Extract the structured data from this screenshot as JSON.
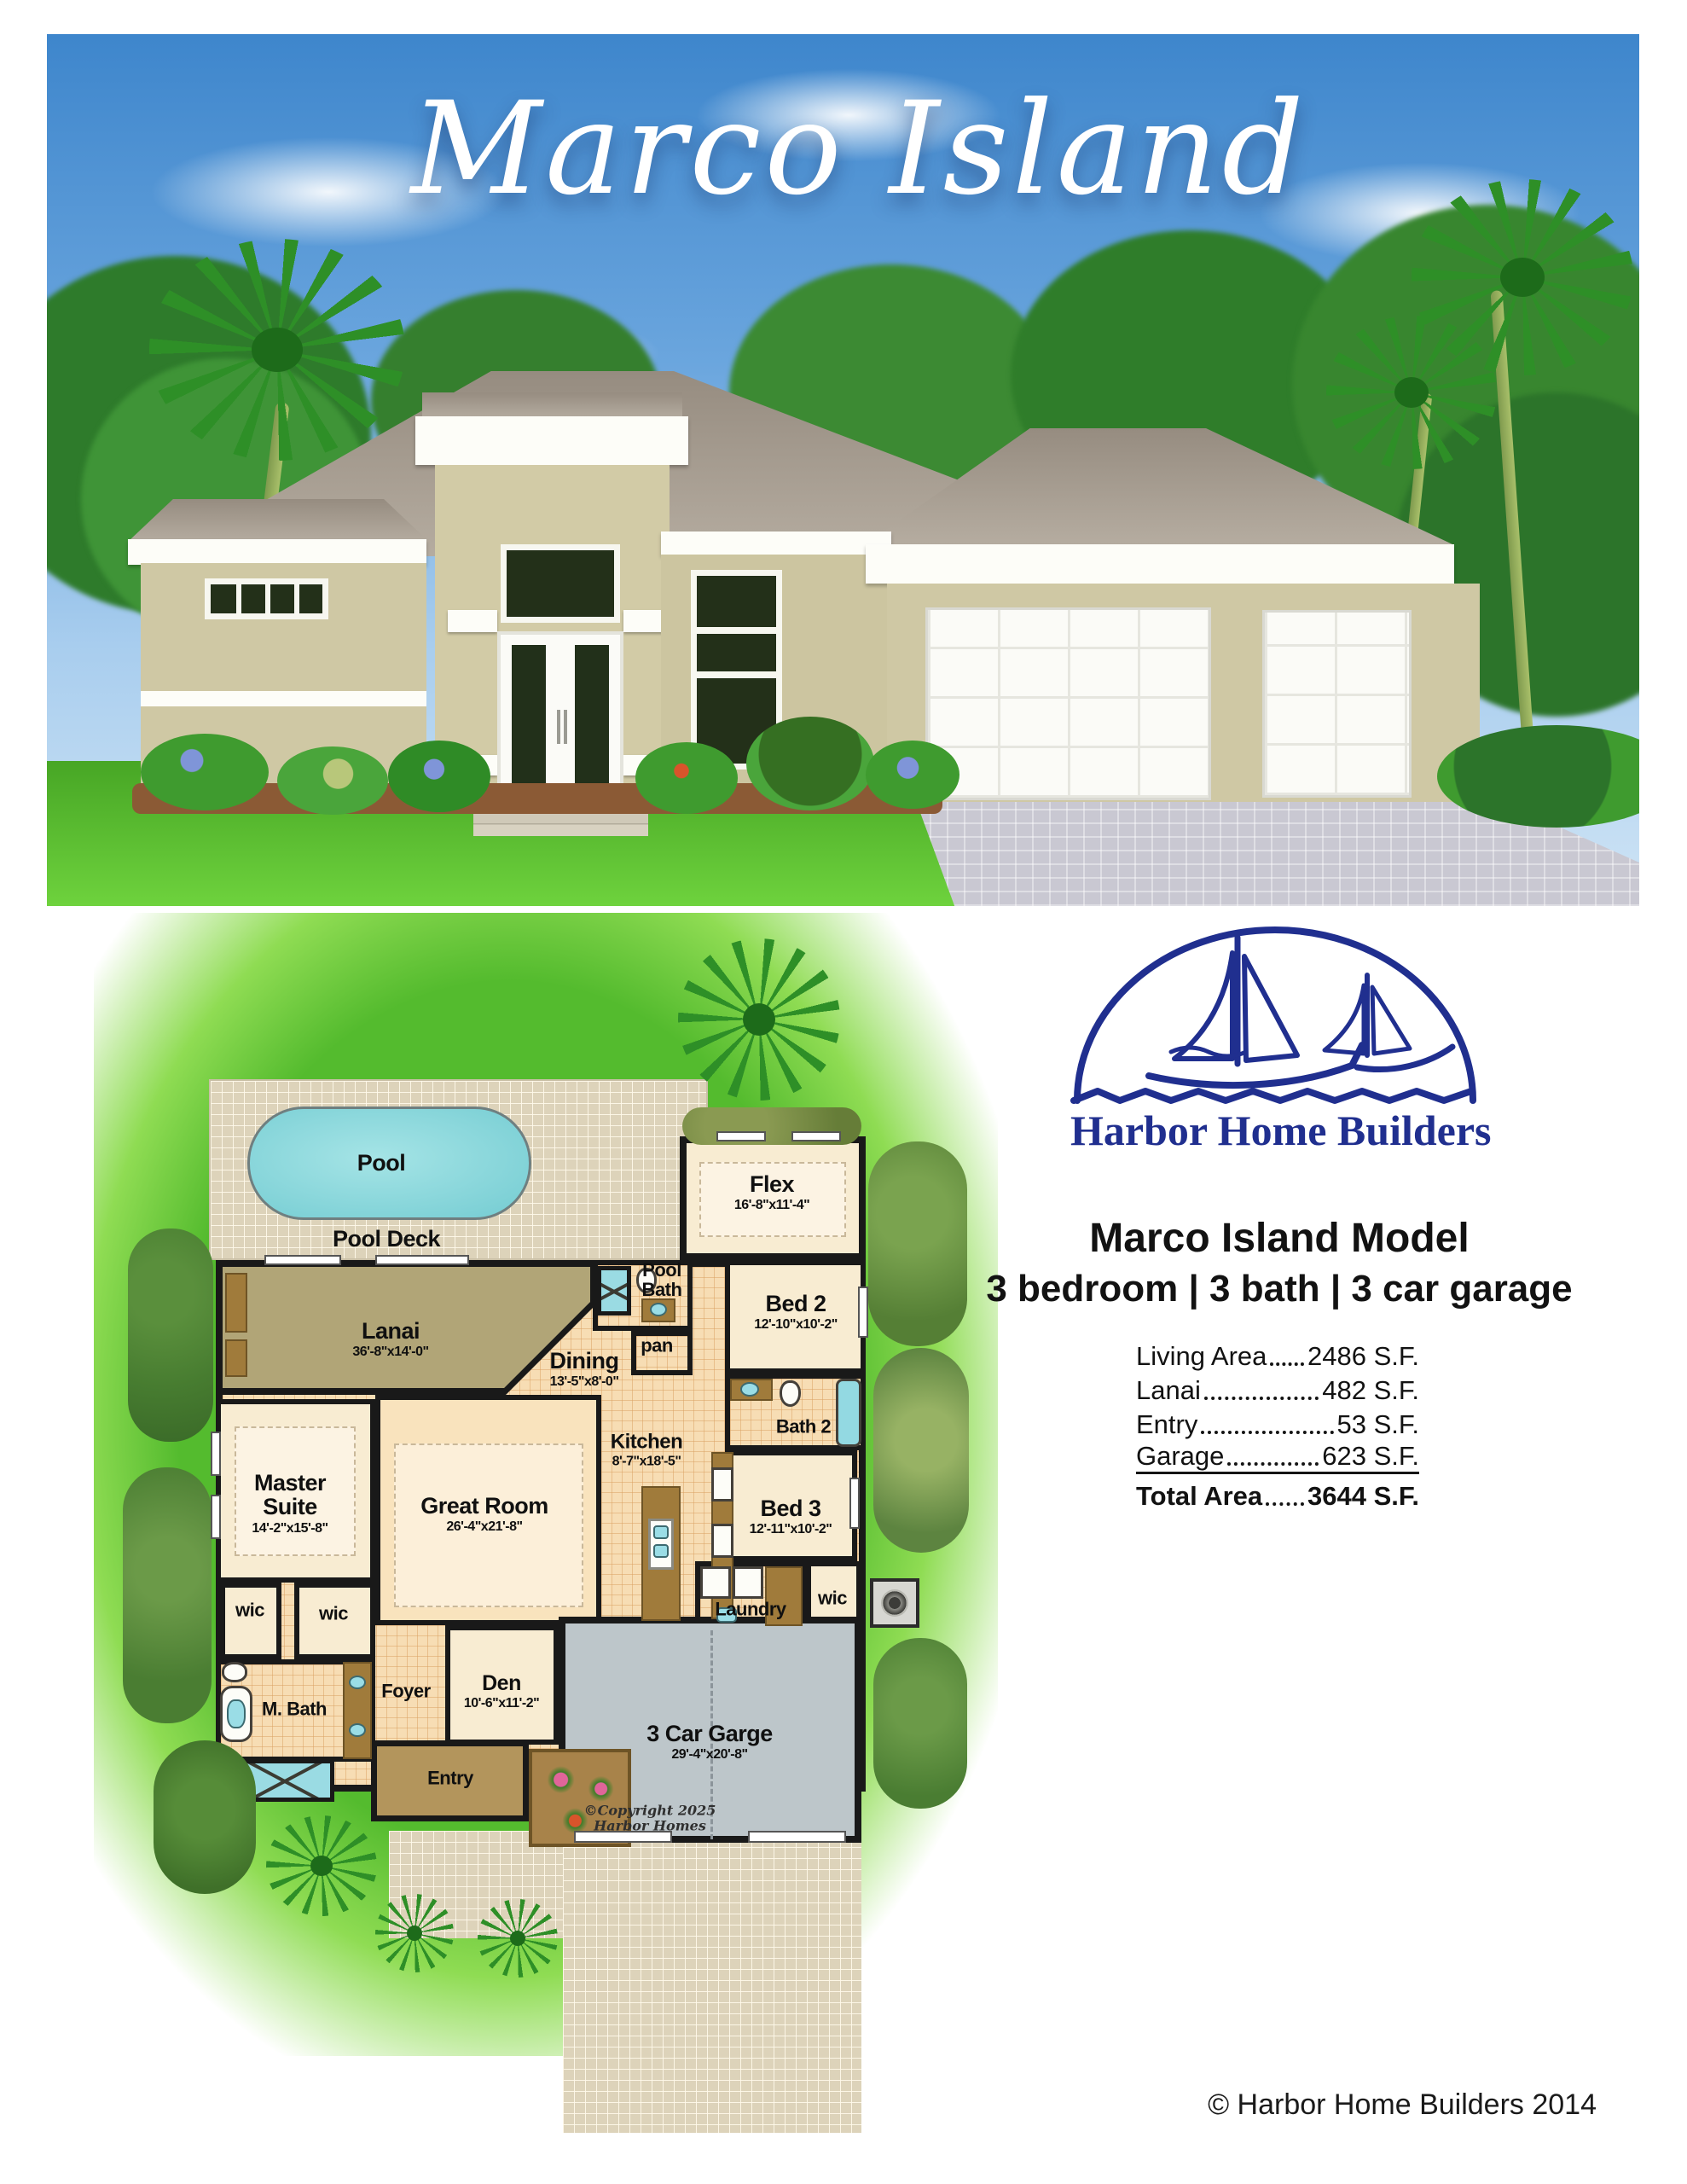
{
  "hero": {
    "title": "Marco Island"
  },
  "brand": {
    "logo_text": "Harbor Home Builders",
    "logo_color": "#202f8f"
  },
  "model": {
    "name": "Marco Island Model",
    "specs": "3 bedroom | 3 bath | 3 car garage"
  },
  "areas": {
    "rows": [
      {
        "label": "Living Area",
        "value": "2486 S.F."
      },
      {
        "label": "Lanai",
        "value": "482 S.F."
      },
      {
        "label": "Entry",
        "value": "53 S.F."
      },
      {
        "label": "Garage",
        "value": "623 S.F."
      }
    ],
    "total": {
      "label": "Total Area",
      "value": "3644 S.F."
    }
  },
  "plan": {
    "pool": {
      "label": "Pool"
    },
    "pool_deck": {
      "label": "Pool Deck"
    },
    "lanai": {
      "label": "Lanai",
      "dims": "36'-8\"x14'-0\""
    },
    "flex": {
      "label": "Flex",
      "dims": "16'-8\"x11'-4\""
    },
    "pool_bath": {
      "line1": "Pool",
      "line2": "Bath"
    },
    "pantry": {
      "label": "pan"
    },
    "bed2": {
      "label": "Bed 2",
      "dims": "12'-10\"x10'-2\""
    },
    "dining": {
      "label": "Dining",
      "dims": "13'-5\"x8'-0\""
    },
    "bath2": {
      "label": "Bath 2"
    },
    "kitchen": {
      "label": "Kitchen",
      "dims": "8'-7\"x18'-5\""
    },
    "master": {
      "line1": "Master",
      "line2": "Suite",
      "dims": "14'-2\"x15'-8\""
    },
    "great_room": {
      "label": "Great Room",
      "dims": "26'-4\"x21'-8\""
    },
    "bed3": {
      "label": "Bed 3",
      "dims": "12'-11\"x10'-2\""
    },
    "laundry": {
      "label": "Laundry"
    },
    "wic1": {
      "label": "wic"
    },
    "wic2": {
      "label": "wic"
    },
    "wic3": {
      "label": "wic"
    },
    "m_bath": {
      "label": "M. Bath"
    },
    "foyer": {
      "label": "Foyer"
    },
    "den": {
      "label": "Den",
      "dims": "10'-6\"x11'-2\""
    },
    "entry": {
      "label": "Entry"
    },
    "garage": {
      "label": "3 Car Garge",
      "dims": "29'-4\"x20'-8\""
    },
    "copyright_line1": "©Copyright 2025",
    "copyright_line2": "Harbor Homes"
  },
  "footer": {
    "copyright": "© Harbor Home Builders 2014"
  },
  "colors": {
    "accent_navy": "#202f8f",
    "sky_blue": "#4b8fd4",
    "lawn_green": "#54bb2e",
    "pool_aqua": "#8fd9dc",
    "wall_tan": "#cfc8a4",
    "roof_gray": "#a39a8e",
    "floor_tile": "#f7ddb4",
    "lanai_tan": "#b1a577",
    "deck_beige": "#ddd3ba",
    "garage_gray": "#bdc6ca"
  }
}
